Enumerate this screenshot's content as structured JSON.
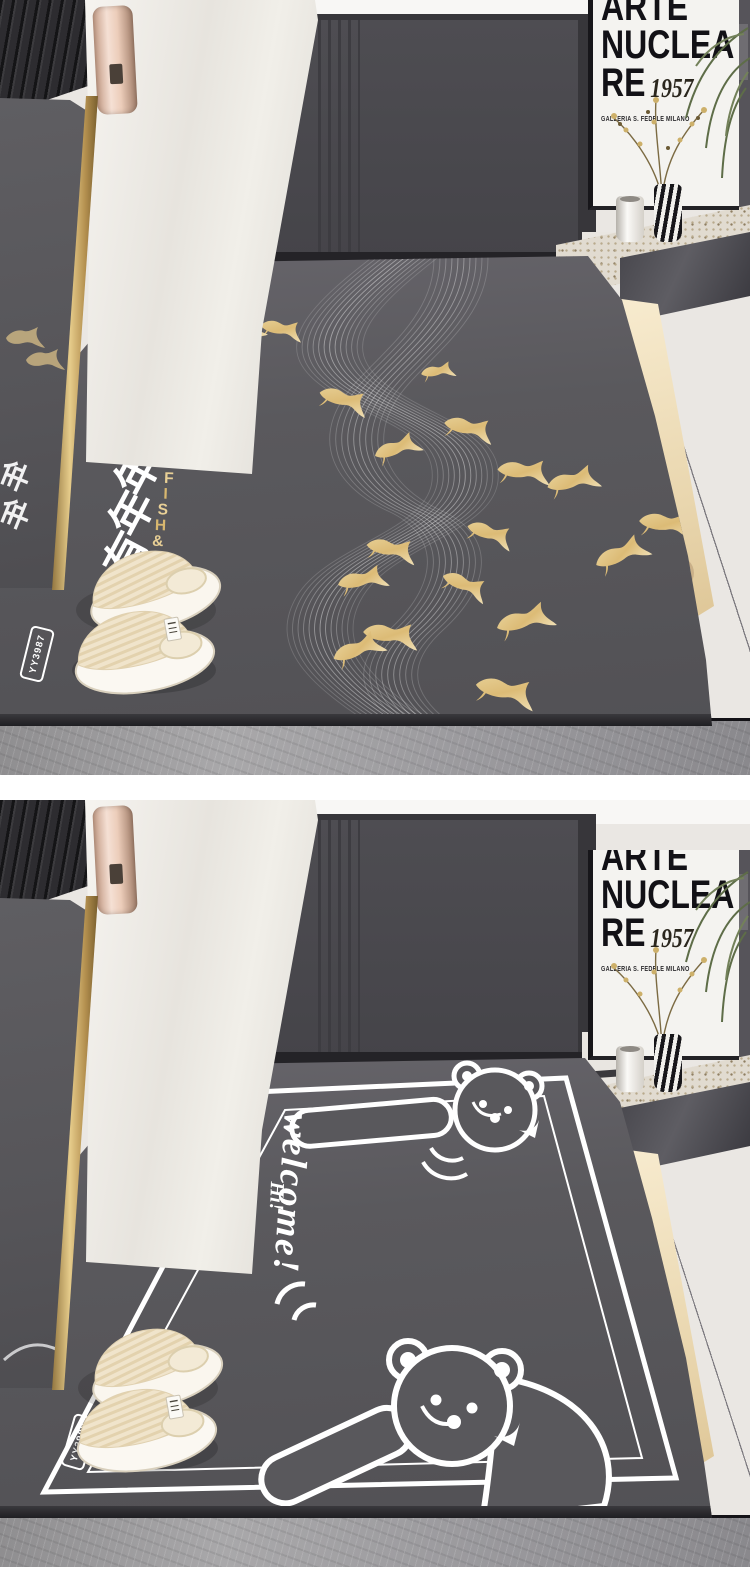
{
  "page": {
    "background_color": "#ffffff"
  },
  "poster": {
    "line1": "ARTE",
    "line2": "NUCLEA",
    "line3": "RE",
    "year": "1957",
    "caption": "GALLERIA S. FEDELE MILANO"
  },
  "mat1": {
    "description": "koi fish entry door mat",
    "blessing_text": "年年有鱼",
    "blessing_chars": [
      "年",
      "年",
      "有",
      "鱼"
    ],
    "brand_text": "FISH&RICH",
    "brand_chars": [
      "F",
      "I",
      "S",
      "H",
      "&",
      "R",
      "I",
      "C",
      "H"
    ],
    "product_code": "YY3987",
    "colors": {
      "mat": "#59585c",
      "fish_gold": "#e3c98c",
      "wave_lines": "#ffffff"
    }
  },
  "mat2": {
    "description": "bear welcome entry door mat",
    "welcome_text": "welcome!",
    "hi_text": "Hi!",
    "product_code": "YY3988",
    "colors": {
      "mat": "#59585c",
      "art_lines": "#ffffff"
    }
  },
  "scene_colors": {
    "wall": "#eae7e3",
    "door": "#4a494e",
    "door_frame": "#37363a",
    "floor_tile": "#9b9a9c",
    "mirror_frame_gold": "#c9a85c",
    "slipper_cream": "#f0e4cb",
    "handle_rose_gold": "#eccdba"
  }
}
